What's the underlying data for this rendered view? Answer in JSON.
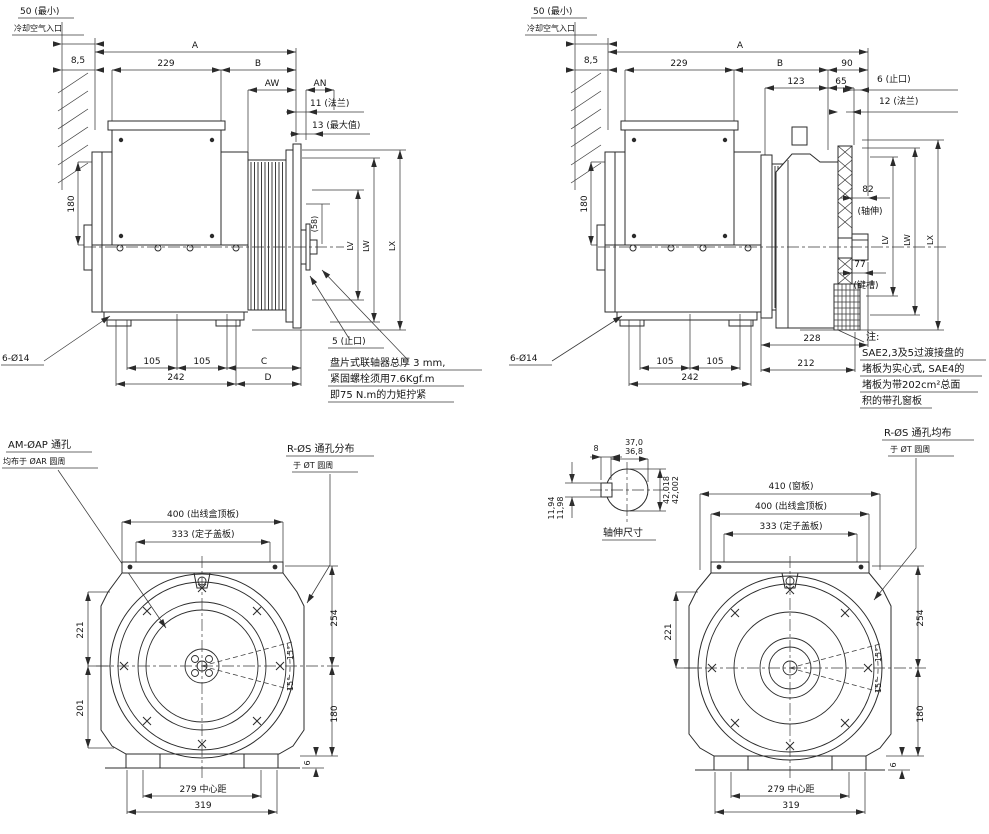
{
  "view_top_left": {
    "air_min": "50 (最小)",
    "air_inlet": "冷却空气入口",
    "d8_5": "8,5",
    "dA": "A",
    "d229": "229",
    "dB": "B",
    "dAW": "AW",
    "dAN": "AN",
    "d11_flange": "11 (法兰)",
    "d13_max": "13 (最大值)",
    "d180": "180",
    "d58": "(58)",
    "dLV": "LV",
    "dLW": "LW",
    "dLX": "LX",
    "d5_spigot": "5 (止口)",
    "holes": "6-Ø14",
    "d105a": "105",
    "d105b": "105",
    "dC": "C",
    "d242": "242",
    "dD": "D",
    "note1": "盘片式联轴器总厚 3 mm,",
    "note2": "紧固螺栓须用7.6Kgf.m",
    "note3": "即75 N.m的力矩拧紧"
  },
  "view_top_right": {
    "air_min": "50 (最小)",
    "air_inlet": "冷却空气入口",
    "d8_5": "8,5",
    "dA": "A",
    "d229": "229",
    "dB": "B",
    "d90": "90",
    "d123": "123",
    "d65": "65",
    "d6_spigot": "6 (止口)",
    "d12_flange": "12 (法兰)",
    "d180": "180",
    "d82": "82",
    "d82_note": "(轴伸)",
    "d77": "77",
    "d77_note": "(键槽)",
    "dLV": "LV",
    "dLW": "LW",
    "dLX": "LX",
    "d228": "228",
    "d212": "212",
    "d105a": "105",
    "d105b": "105",
    "d242": "242",
    "holes": "6-Ø14",
    "note_head": "注:",
    "note1": "SAE2,3及5过渡接盘的",
    "note2": "堵板为实心式, SAE4的",
    "note3": "堵板为带202cm²总面",
    "note4": "积的带孔窗板"
  },
  "view_bottom_left": {
    "am_line1": "AM-ØAP 通孔",
    "am_line2": "均布于 ØAR 圆周",
    "rs_line1": "R-ØS 通孔分布",
    "rs_line2": "于 ØT 圆周",
    "d400": "400 (出线盒顶板)",
    "d333": "333 (定子盖板)",
    "d221": "221",
    "d201": "201",
    "d254": "254",
    "d180": "180",
    "ang_top": "15°",
    "ang_bottom": "15°",
    "d6": "6",
    "d279": "279 中心距",
    "d319": "319"
  },
  "view_bottom_right": {
    "shaft": {
      "d37_hi": "37,0",
      "d37_lo": "36,8",
      "d8": "8",
      "dia_hi": "42,018",
      "dia_lo": "42,002",
      "key_hi": "11,94",
      "key_lo": "11,98",
      "title": "轴伸尺寸"
    },
    "rs_line1": "R-ØS 通孔均布",
    "rs_line2": "于 ØT 圆周",
    "d410": "410 (窗板)",
    "d400": "400 (出线盒顶板)",
    "d333": "333 (定子盖板)",
    "d221": "221",
    "d254": "254",
    "d180": "180",
    "ang_top": "15°",
    "ang_bottom": "15°",
    "d6": "6",
    "d279": "279 中心距",
    "d319": "319"
  }
}
